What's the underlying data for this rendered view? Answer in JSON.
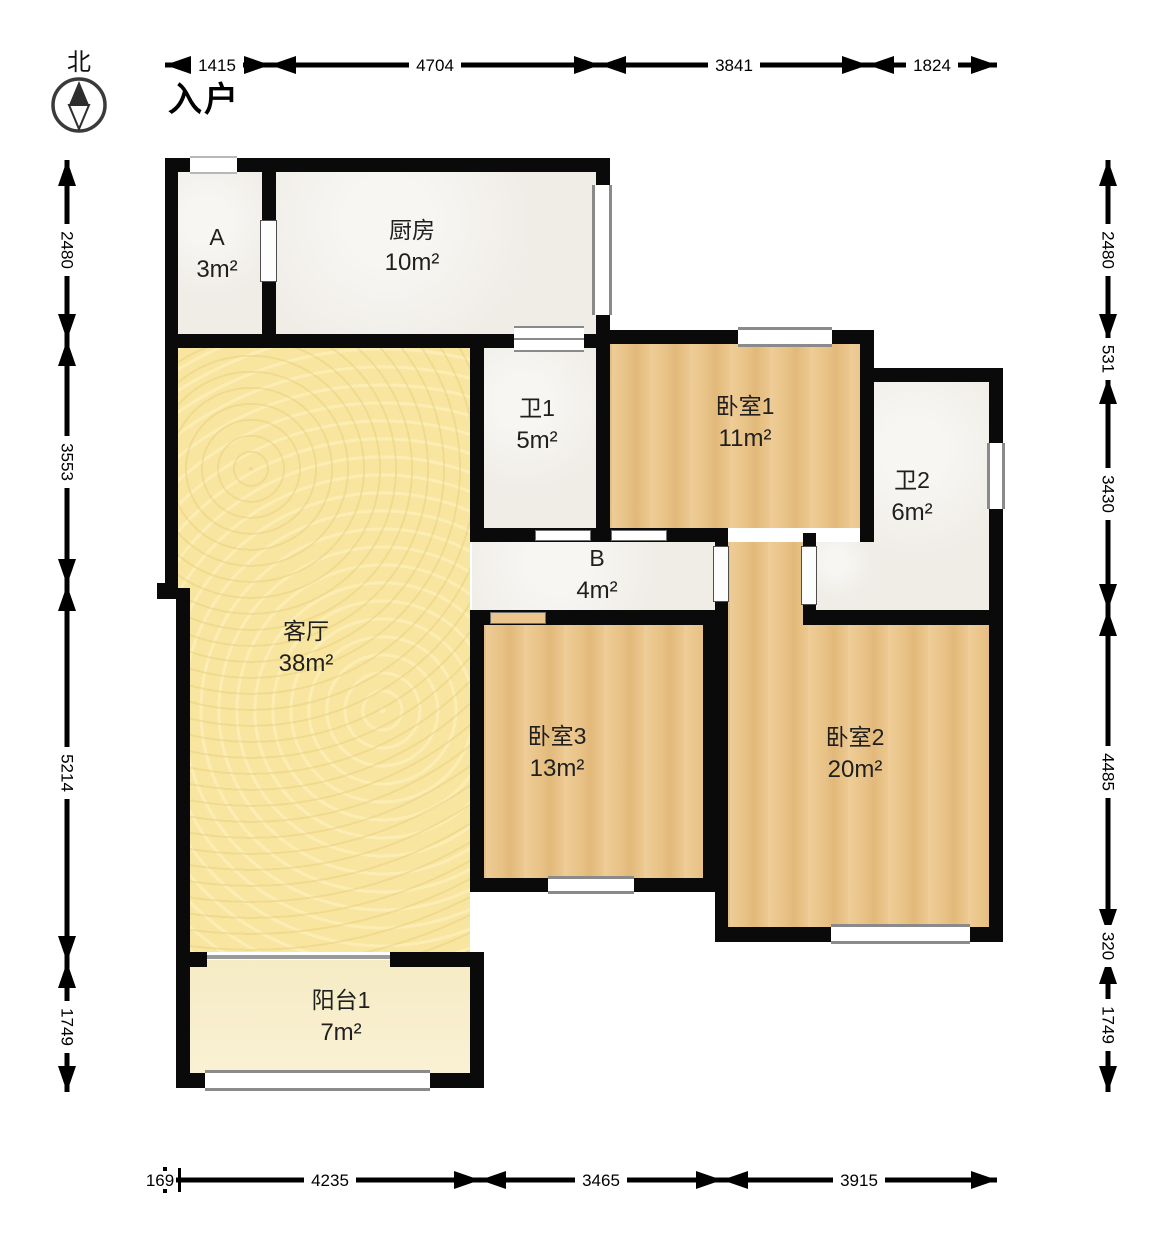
{
  "compass": {
    "label": "北"
  },
  "entry_label": "入户",
  "rooms": [
    {
      "id": "room-a",
      "name": "A",
      "area": "3m²"
    },
    {
      "id": "kitchen",
      "name": "厨房",
      "area": "10m²"
    },
    {
      "id": "bath1",
      "name": "卫1",
      "area": "5m²"
    },
    {
      "id": "bedroom1",
      "name": "卧室1",
      "area": "11m²"
    },
    {
      "id": "bath2",
      "name": "卫2",
      "area": "6m²"
    },
    {
      "id": "hall-b",
      "name": "B",
      "area": "4m²"
    },
    {
      "id": "living",
      "name": "客厅",
      "area": "38m²"
    },
    {
      "id": "bedroom3",
      "name": "卧室3",
      "area": "13m²"
    },
    {
      "id": "bedroom2",
      "name": "卧室2",
      "area": "20m²"
    },
    {
      "id": "balcony1",
      "name": "阳台1",
      "area": "7m²"
    }
  ],
  "dimensions": {
    "top": [
      "1415",
      "4704",
      "3841",
      "1824"
    ],
    "left": [
      "2480",
      "3553",
      "5214",
      "1749"
    ],
    "right": [
      "2480",
      "531",
      "3430",
      "4485",
      "320",
      "1749"
    ],
    "bottom": [
      "169",
      "4235",
      "3465",
      "3915"
    ]
  },
  "colors": {
    "wall": "#0a0a0a",
    "living_floor": "#f8e6a0",
    "wood_floor": "#eac58c",
    "tile_floor": "#f0ede7",
    "balcony_floor": "#f7edc9",
    "window_frame": "#8a8a8a",
    "dimension_line": "#000000"
  }
}
